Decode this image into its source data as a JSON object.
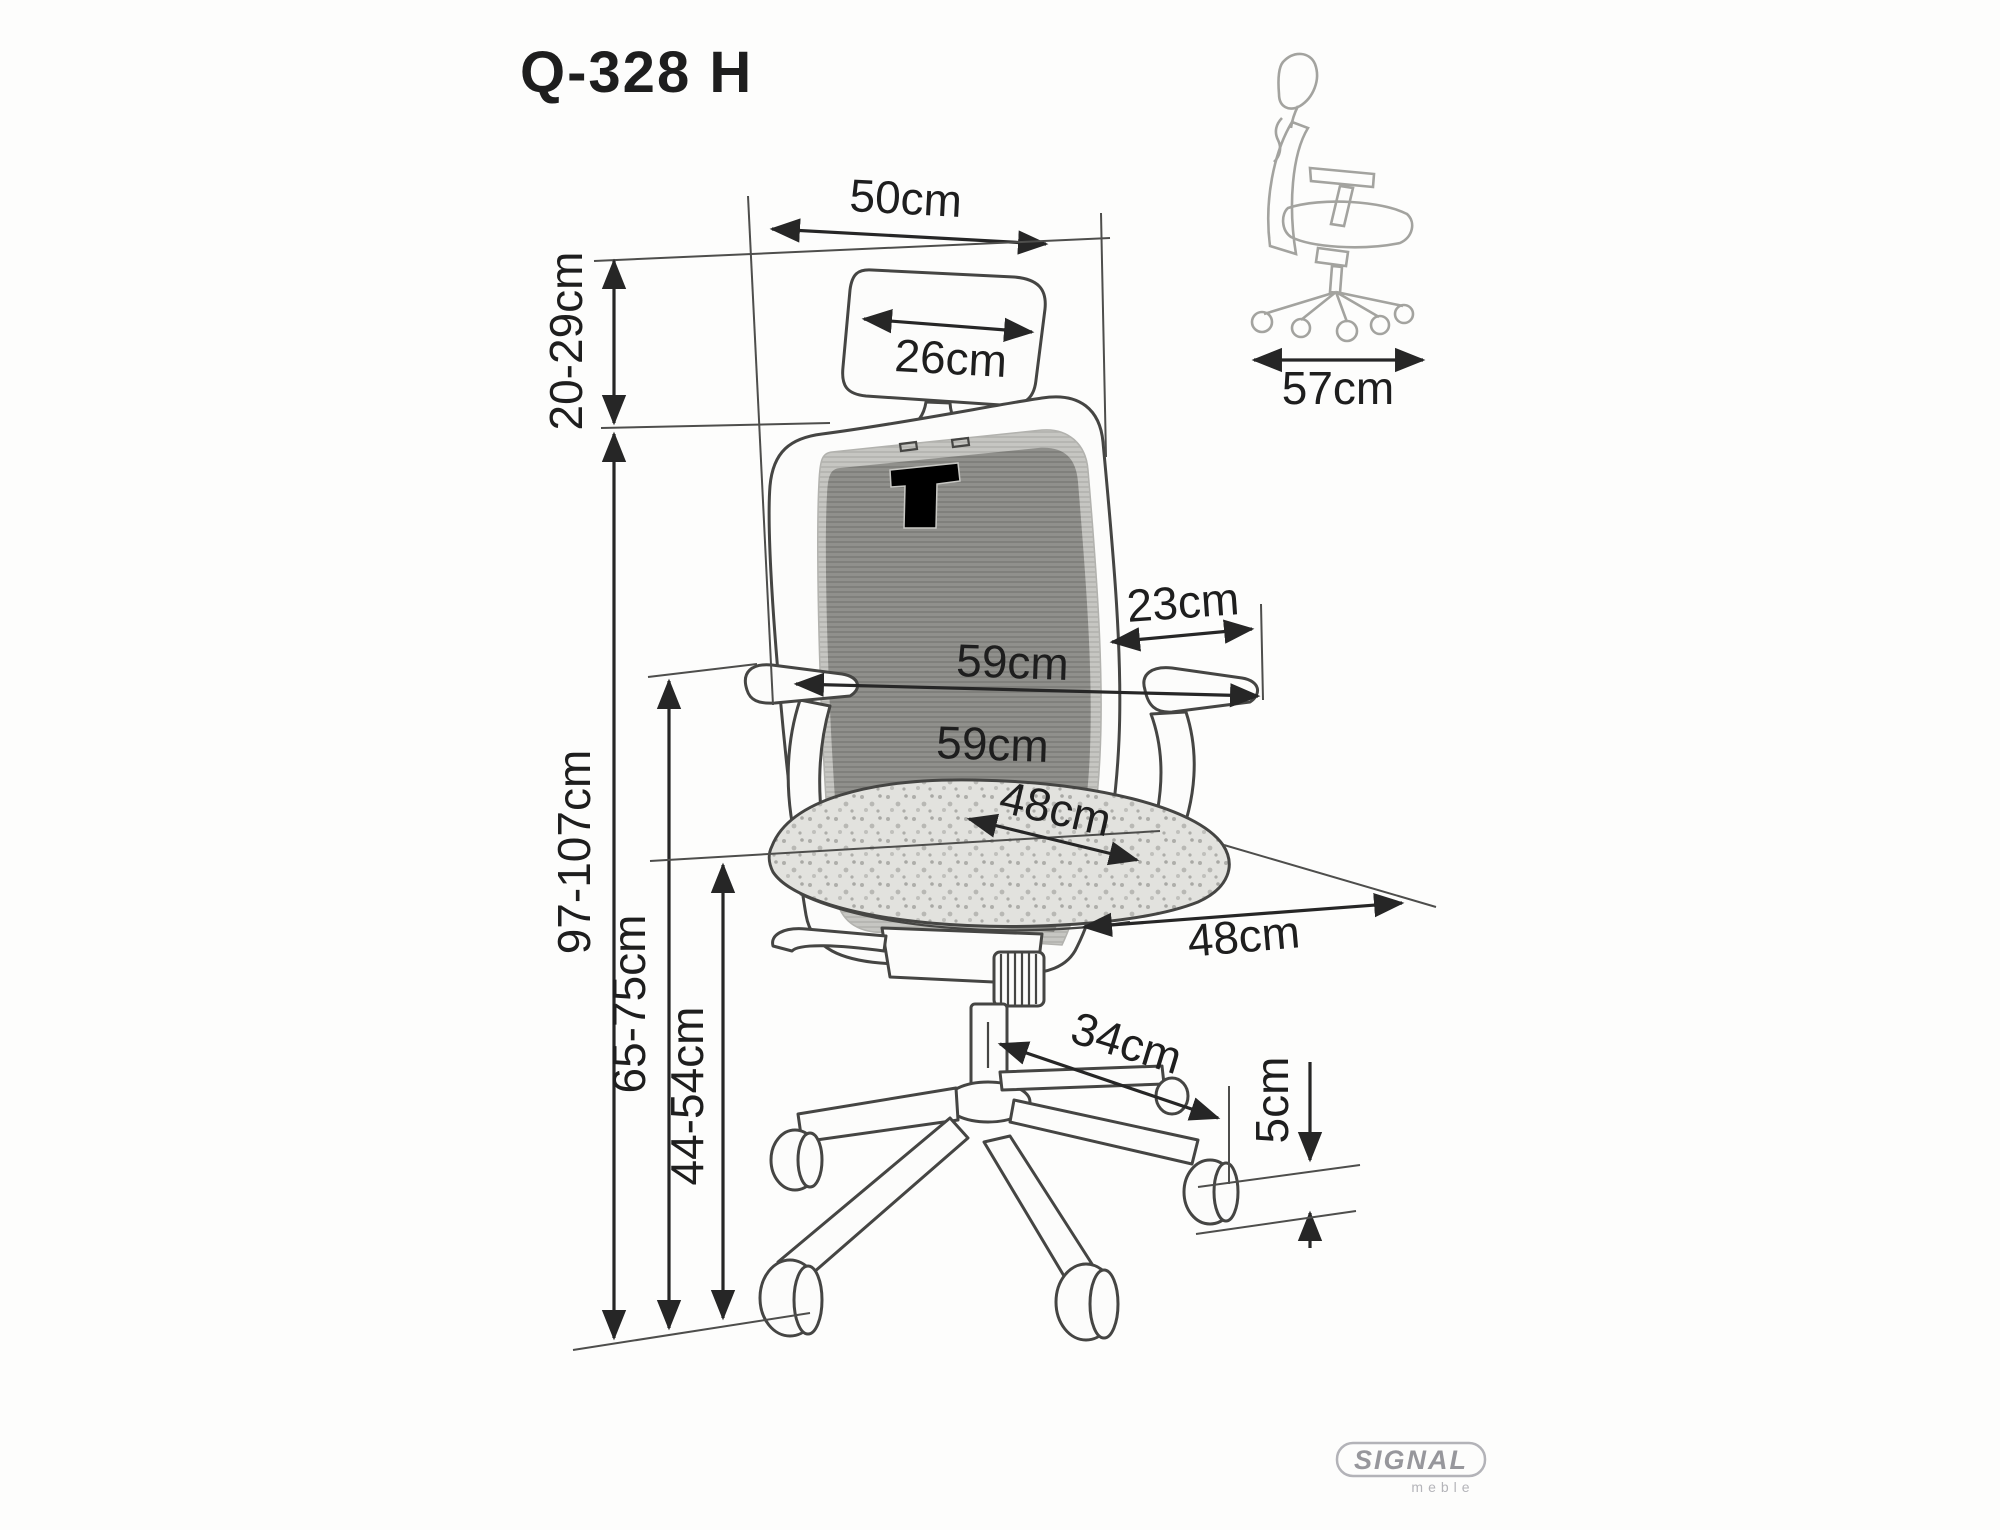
{
  "title": "Q-328 H",
  "colors": {
    "line": "#454543",
    "dimension": "#262626",
    "mesh_dark": "#90908c",
    "mesh_light": "#c6c6c2",
    "seat_fabric": "#e2e2de",
    "side_view_line": "#a3a39f",
    "logo_gray": "#97979c"
  },
  "main_view": {
    "dims": {
      "backrest_width": "50cm",
      "headrest_range": "20-29cm",
      "headrest_width": "26cm",
      "armrest_pad_depth": "23cm",
      "width_armrests": "59cm",
      "width_mid": "59cm",
      "seat_width": "48cm",
      "seat_depth": "48cm",
      "total_height": "97-107cm",
      "armrest_height": "65-75cm",
      "seat_height": "44-54cm",
      "base_arm_length": "34cm",
      "caster_diameter": "5cm"
    }
  },
  "side_view": {
    "depth": "57cm"
  },
  "logo": {
    "brand": "SIGNAL",
    "sub": "meble"
  }
}
